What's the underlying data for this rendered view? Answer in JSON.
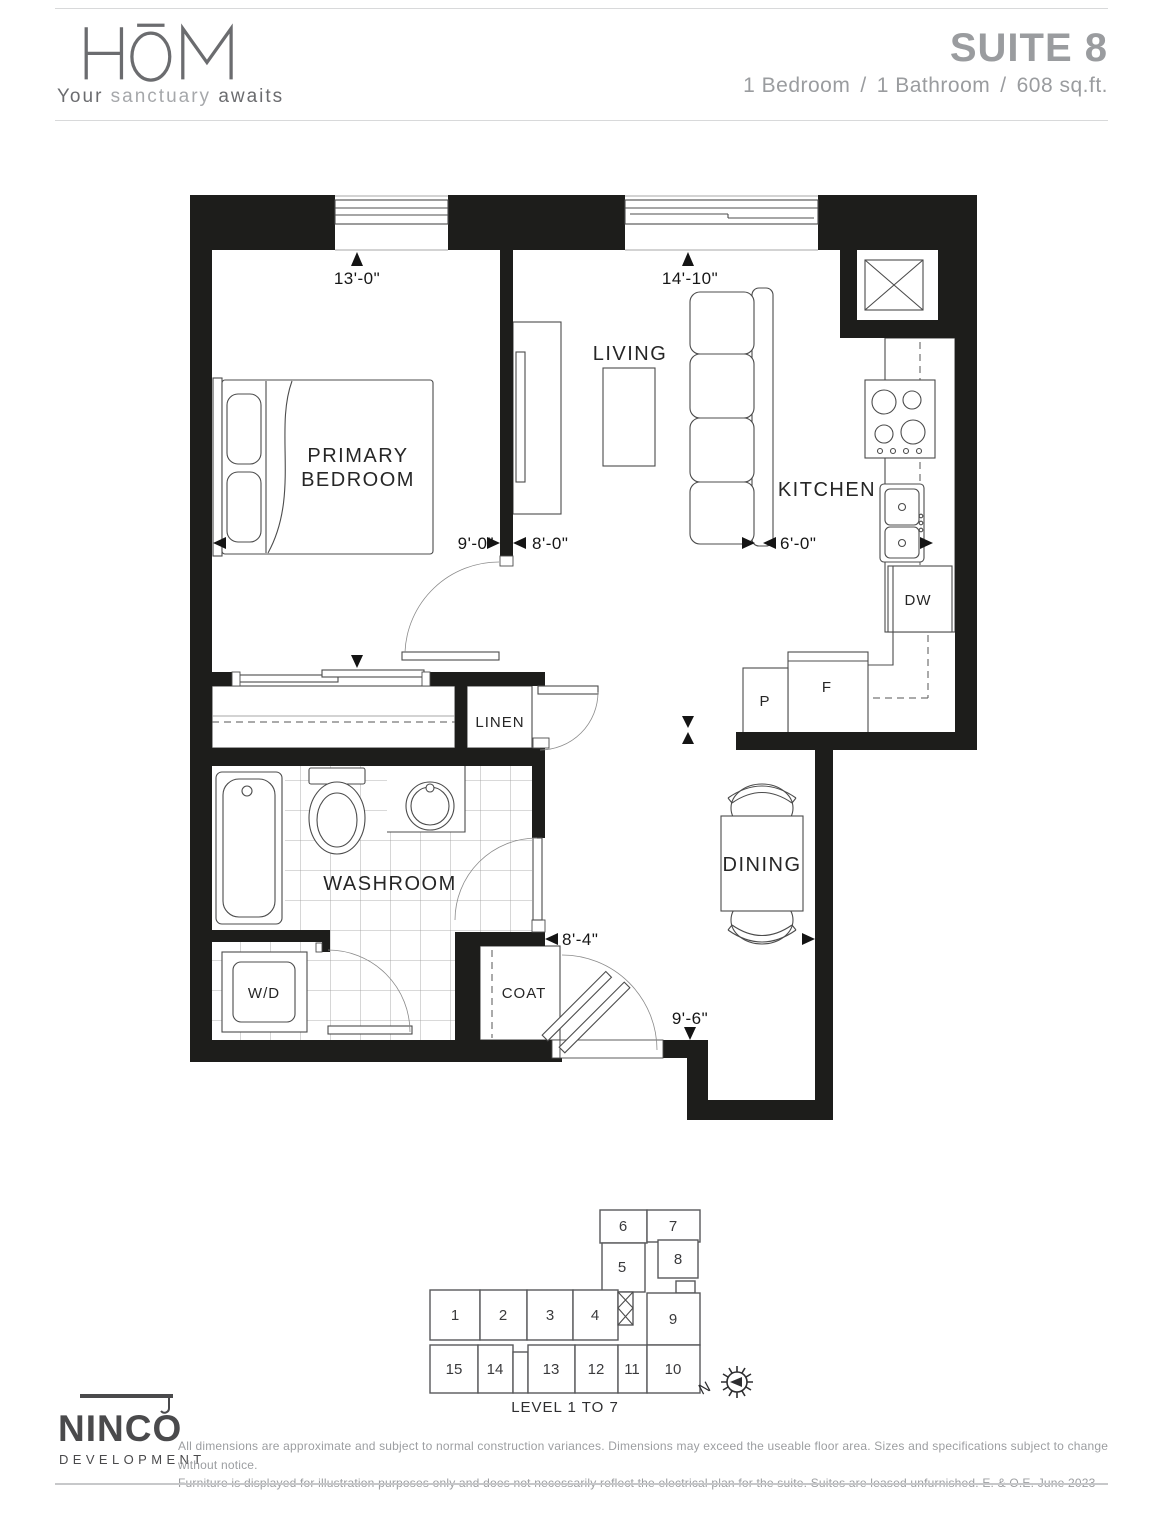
{
  "header": {
    "logo_text": "HŌM",
    "tagline_word1": "Your",
    "tagline_word2": "sanctuary",
    "tagline_word3": "awaits",
    "suite_title": "SUITE 8",
    "spec_bedroom": "1 Bedroom",
    "spec_bathroom": "1 Bathroom",
    "spec_area": "608 sq.ft.",
    "spec_separator": "/"
  },
  "plan": {
    "rooms": {
      "primary_line1": "PRIMARY",
      "primary_line2": "BEDROOM",
      "living": "LIVING",
      "kitchen": "KITCHEN",
      "washroom": "WASHROOM",
      "dining": "DINING",
      "linen": "LINEN",
      "coat": "COAT",
      "wd": "W/D",
      "dw": "DW",
      "fridge": "F",
      "pantry": "P"
    },
    "dims": {
      "bedroom_window": "13'-0\"",
      "living_window": "14'-10\"",
      "bedroom_width": "9'-0\"",
      "living_width": "8'-0\"",
      "kitchen_width": "6'-0\"",
      "hall_width": "8'-4\"",
      "entry_width": "9'-6\""
    },
    "wall_color": "#1d1d1b"
  },
  "keyplan": {
    "units": [
      {
        "label": "1"
      },
      {
        "label": "2"
      },
      {
        "label": "3"
      },
      {
        "label": "4"
      },
      {
        "label": "5"
      },
      {
        "label": "6"
      },
      {
        "label": "7"
      },
      {
        "label": "8"
      },
      {
        "label": "9"
      },
      {
        "label": "10"
      },
      {
        "label": "11"
      },
      {
        "label": "12"
      },
      {
        "label": "13"
      },
      {
        "label": "14"
      },
      {
        "label": "15"
      }
    ],
    "highlighted_unit": "8",
    "highlight_color": "#d1d3d4",
    "level_label": "LEVEL 1 TO 7",
    "north_label": "N"
  },
  "footer": {
    "brand": "NINCO",
    "brand_sub": "DEVELOPMENTS",
    "disclaimer_line1": "All dimensions are approximate and subject to normal construction variances. Dimensions may exceed the useable floor area. Sizes and specifications subject to change without notice.",
    "disclaimer_line2": "Furniture is displayed for illustration purposes only and does not necessarily reflect the electrical plan for the suite. Suites are leased unfurnished. E. & O.E. June 2023"
  }
}
